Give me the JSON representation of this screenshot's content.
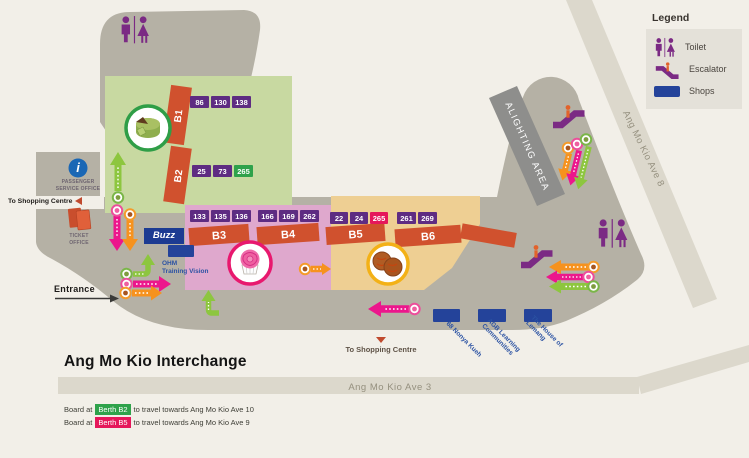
{
  "legend": {
    "title": "Legend",
    "items": [
      {
        "icon": "toilet-icon",
        "label": "Toilet"
      },
      {
        "icon": "escalator-icon",
        "label": "Escalator"
      },
      {
        "icon": "shops-swatch",
        "label": "Shops"
      }
    ]
  },
  "roads": {
    "ave8_label": "Ang Mo Kio Ave 8",
    "ave3_label": "Ang Mo Kio Ave 3"
  },
  "map": {
    "alighting_label": "ALIGHTING AREA",
    "entrance_label": "Entrance",
    "to_shopping_left": "To Shopping Centre",
    "to_shopping_bottom": "To Shopping Centre",
    "passenger_office": {
      "line1": "PASSENGER",
      "line2": "SERVICE OFFICE",
      "glyph": "i"
    },
    "ticket_office": {
      "line1": "TICKET",
      "line2": "OFFICE"
    }
  },
  "berths": {
    "b1": {
      "label": "B1",
      "services": [
        "86",
        "130",
        "138"
      ]
    },
    "b2": {
      "label": "B2",
      "services": [
        "25",
        "73",
        "265"
      ]
    },
    "b3": {
      "label": "B3",
      "services": [
        "133",
        "135",
        "136"
      ]
    },
    "b4": {
      "label": "B4",
      "services": [
        "166",
        "169",
        "262"
      ]
    },
    "b5": {
      "label": "B5",
      "services": [
        "22",
        "24",
        "265"
      ]
    },
    "b6": {
      "label": "B6",
      "services": [
        "261",
        "269"
      ]
    }
  },
  "shops": {
    "buzz": "Buzz",
    "ohm_line1": "OHM",
    "ohm_line2": "Training Vision",
    "nonya": "68 Nonya Kueh",
    "agb_line1": "AGB Learning",
    "agb_line2": "Communities",
    "lemang_line1": "The House of",
    "lemang_line2": "Lemang"
  },
  "title": "Ang Mo Kio Interchange",
  "notes": {
    "n1": {
      "prefix": "Board at",
      "badge": "Berth B2",
      "suffix": "to travel towards Ang Mo Kio Ave 10"
    },
    "n2": {
      "prefix": "Board at",
      "badge": "Berth B5",
      "suffix": "to travel towards Ang Mo Kio Ave 9"
    }
  },
  "colors": {
    "background": "#f2efe8",
    "concourse": "#b5b1a5",
    "road": "#dcd8cc",
    "alighting_band": "#8e8e8c",
    "zone_green": "#c8d9a1",
    "zone_pink": "#dfa8cd",
    "zone_tan": "#eecf93",
    "berth_bar": "#d0512e",
    "service_purple": "#5e2c82",
    "service_green": "#2fa24b",
    "service_crimson": "#e5175a",
    "shops_navy": "#24439a",
    "arrow_green": "#8dc63f",
    "arrow_pink": "#ec168c",
    "arrow_orange": "#f6921e",
    "facility_purple": "#7b2a84",
    "blue_text": "#2b52a3",
    "info_blue": "#1a67b5"
  }
}
